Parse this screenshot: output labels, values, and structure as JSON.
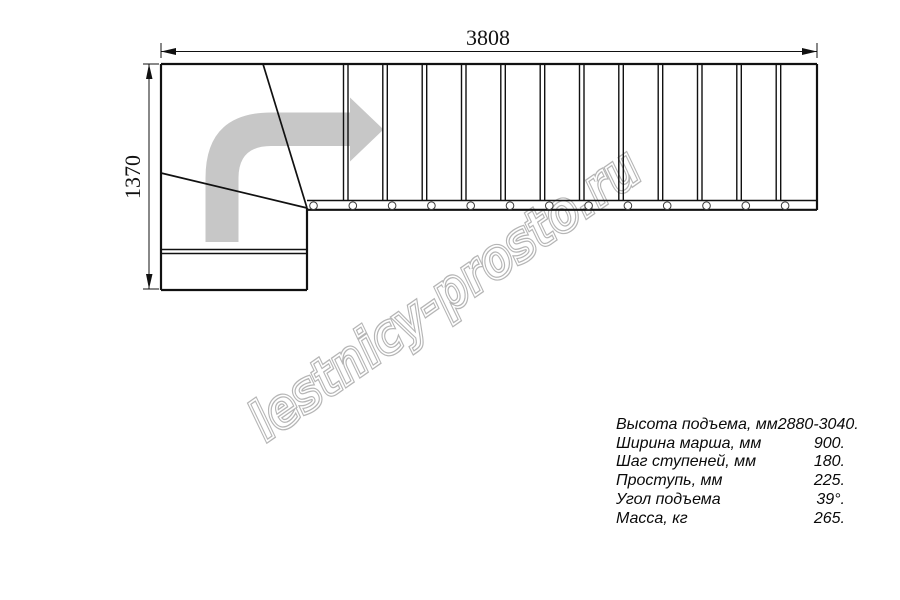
{
  "drawing": {
    "title": "staircase-plan-top-view",
    "dimension_top_mm": "3808",
    "dimension_left_mm": "1370",
    "tread_count_straight": 13,
    "bolt_circle_count": 13,
    "direction_arrow": "arrow-turn-right-icon"
  },
  "watermark": {
    "text": "lestnicy-prosto.ru"
  },
  "specs": {
    "rows": [
      {
        "label": "Высота подъема, мм",
        "value": "2880-3040."
      },
      {
        "label": "Ширина марша, мм",
        "value": "900."
      },
      {
        "label": "Шаг ступеней, мм",
        "value": "180."
      },
      {
        "label": "Проступь, мм",
        "value": "225."
      },
      {
        "label": "Угол подъема",
        "value": "39°."
      },
      {
        "label": "Масса, кг",
        "value": "265."
      }
    ]
  },
  "colors": {
    "line": "#111111",
    "arrow_fill": "#c7c7c7",
    "watermark_outline": "#b5b5b5",
    "watermark_inner": "#ffffff"
  }
}
